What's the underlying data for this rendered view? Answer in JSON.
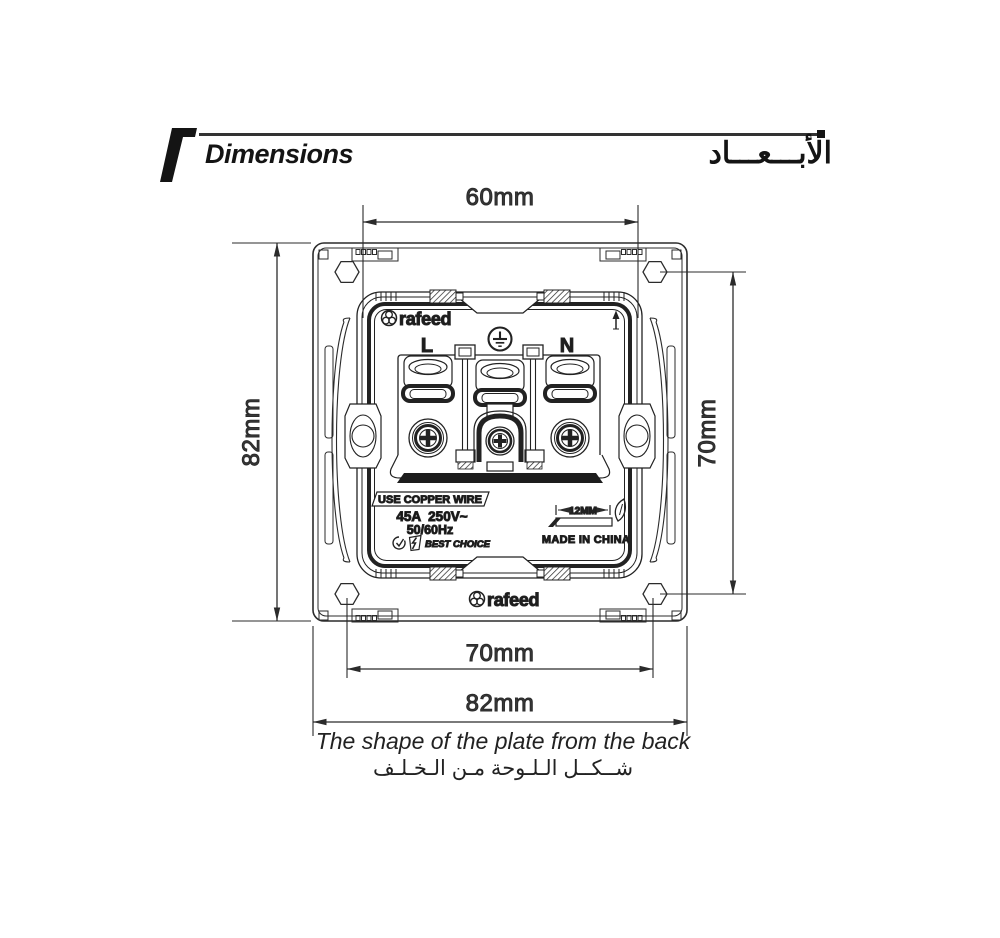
{
  "header": {
    "title_en": "Dimensions",
    "title_ar": "الأبـــعـــاد"
  },
  "dims": {
    "top": "60mm",
    "left": "82mm",
    "right": "70mm",
    "bottom_inner": "70mm",
    "bottom_outer": "82mm"
  },
  "mechanism": {
    "brand": "rafeed",
    "terminal_live": "L",
    "terminal_neutral": "N",
    "warning": "USE COPPER WIRE",
    "rating_current_voltage": "45A  250V~",
    "rating_frequency": "50/60Hz",
    "slogan": "BEST CHOICE",
    "strip_length": "12MM",
    "origin": "MADE IN CHINA"
  },
  "plate": {
    "brand": "rafeed"
  },
  "caption": {
    "en": "The shape of the plate from the back",
    "ar": "شــكــل الـلـوحة مـن الـخـلـف"
  },
  "colors": {
    "ink": "#1d1d1d",
    "line": "#2b2b2b",
    "dim_text": "#383838"
  }
}
